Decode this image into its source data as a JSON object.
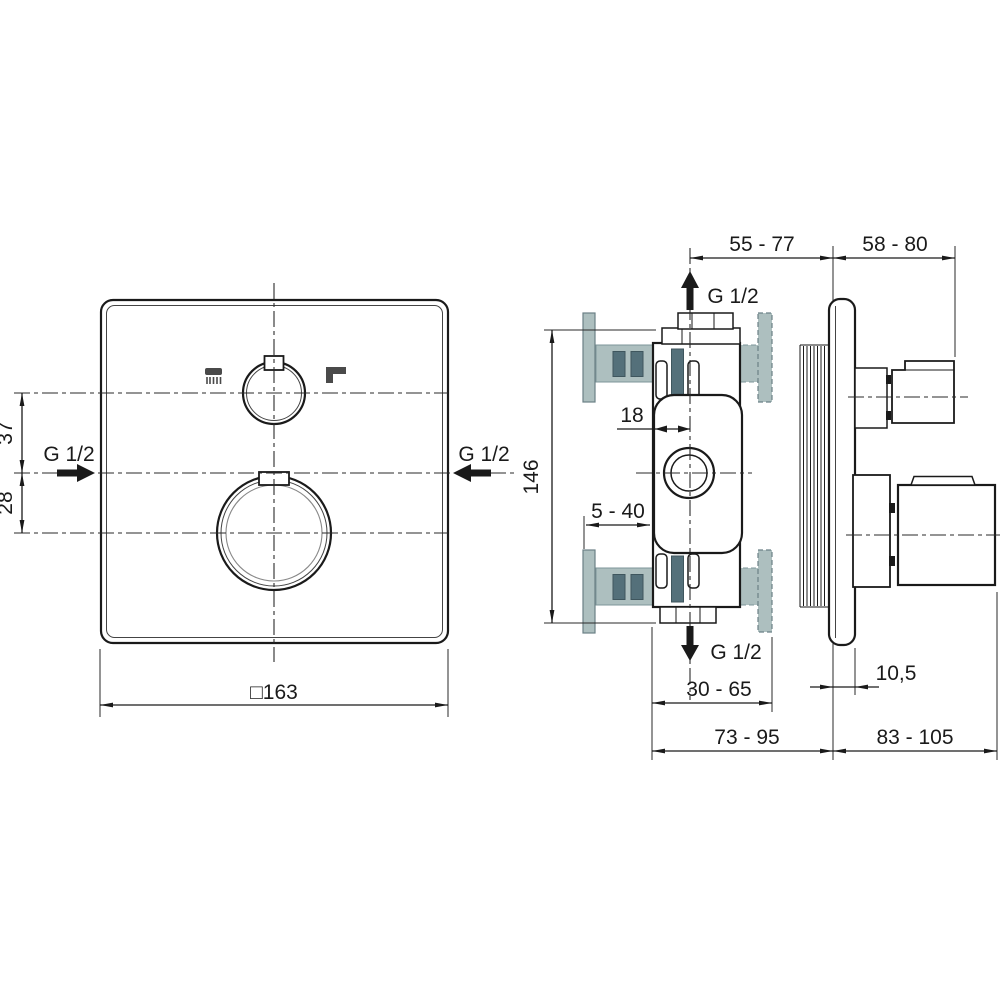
{
  "front_view": {
    "g12_left_label": "G 1/2",
    "g12_right_label": "G 1/2",
    "dim_top_offset": "37",
    "dim_bottom_offset": "28",
    "dim_width": "□163"
  },
  "side_view": {
    "dim_depth_inner": "55 - 77",
    "dim_handle_top": "58 - 80",
    "g12_top_label": "G 1/2",
    "g12_bottom_label": "G 1/2",
    "dim_height": "146",
    "dim_center_offset": "18",
    "dim_tile_range": "5 - 40",
    "dim_embed_depth": "30 - 65",
    "dim_plate_thickness": "10,5",
    "dim_total_depth_left": "73 - 95",
    "dim_total_depth_right": "83 - 105"
  },
  "colors": {
    "line": "#1a1a1a",
    "light_gray": "#adbfbf",
    "dark_gray": "#54707a",
    "icon_gray": "#4a4a4a"
  }
}
